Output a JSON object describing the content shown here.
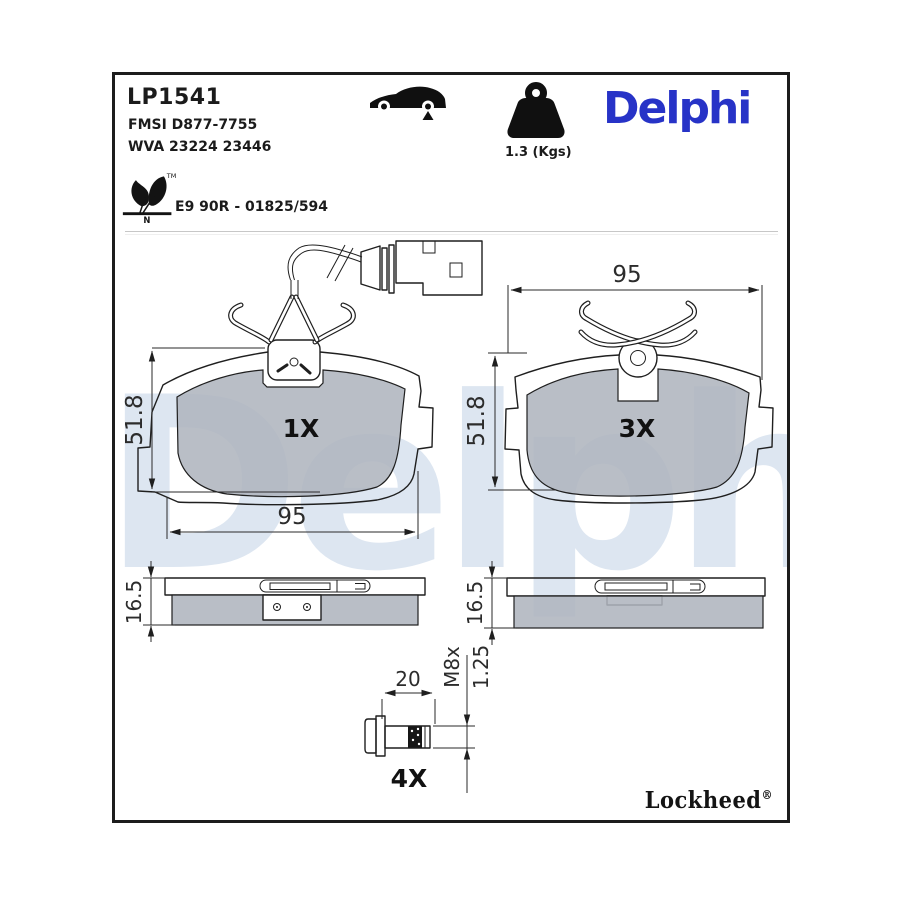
{
  "header": {
    "part_number": "LP1541",
    "fmsi": "FMSI D877-7755",
    "wva": "WVA 23224 23446",
    "weight": "1.3 (Kgs)",
    "brand_logo": "Delphi",
    "homologation": "E9 90R - 01825/594",
    "leaf_tm": "TM",
    "leaf_n": "N"
  },
  "drawing": {
    "pad_width": "95",
    "pad_height": "51.8",
    "pad_thickness": "16.5",
    "front_left_count": "1X",
    "front_right_count": "3X",
    "bolt_count": "4X",
    "bolt_length": "20",
    "bolt_thread_a": "M8x",
    "bolt_thread_b": "1.25"
  },
  "footer": {
    "sub_brand": "Lockheed",
    "registered_mark": "®"
  },
  "watermark": "Delphi",
  "icons": {
    "vehicle": "car-side-icon",
    "mass": "kettlebell-weight-icon",
    "eco": "leaf-eco-icon"
  },
  "colors": {
    "brand_blue": "#2733c7",
    "pad_gray": "#b9bec4",
    "watermark_blue": "#dde6f1",
    "line": "#1f1f1f"
  }
}
